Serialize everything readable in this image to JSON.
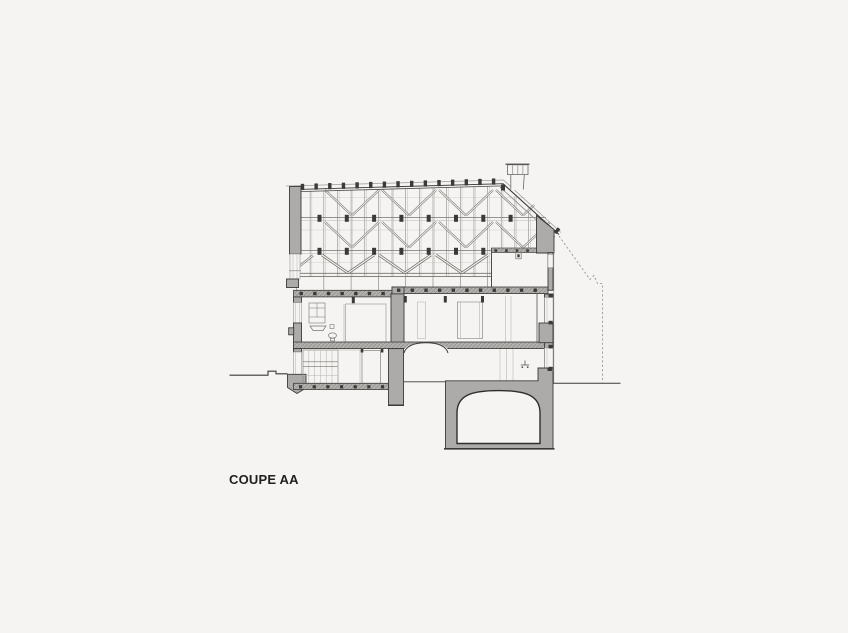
{
  "drawing": {
    "label": "COUPE AA"
  },
  "colors": {
    "background": "#f5f4f2",
    "wall_fill": "#adabaa",
    "line_dark": "#3a3a38",
    "line_mid": "#74736e",
    "line_light": "#b8b6b2",
    "hatch_base": "#b2b0ad",
    "hatch_line": "#8e8d8a",
    "text": "#1f1f1e"
  }
}
